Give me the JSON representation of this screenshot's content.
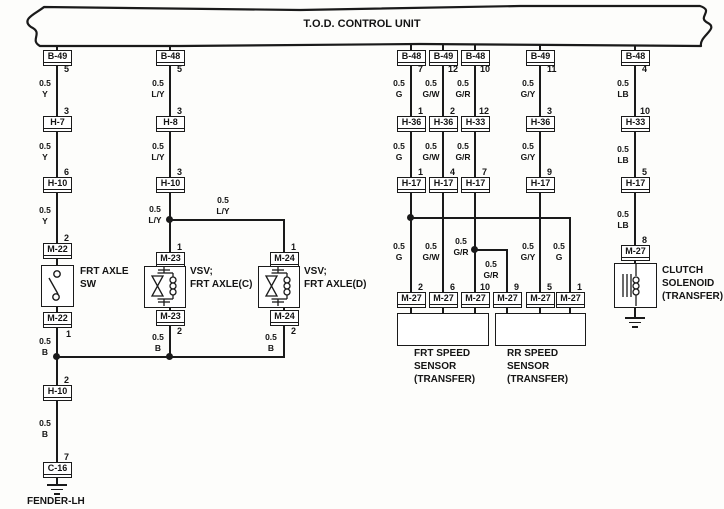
{
  "title": "T.O.D. CONTROL UNIT",
  "footer_label": "FENDER-LH",
  "boxes": {
    "c1_b49": {
      "name": "B-49",
      "pin": "5"
    },
    "c1_h7": {
      "name": "H-7",
      "pin": "3"
    },
    "c1_h10a": {
      "name": "H-10",
      "pin": "6"
    },
    "c1_m22a": {
      "name": "M-22",
      "pin": "2"
    },
    "c1_m22b": {
      "name": "M-22",
      "pin": "1"
    },
    "c1_h10b": {
      "name": "H-10",
      "pin": "2"
    },
    "c1_c16": {
      "name": "C-16",
      "pin": "7"
    },
    "c2_b48": {
      "name": "B-48",
      "pin": "5"
    },
    "c2_h8": {
      "name": "H-8",
      "pin": "3"
    },
    "c2_h10": {
      "name": "H-10",
      "pin": "3"
    },
    "c2_m23a": {
      "name": "M-23",
      "pin": "1"
    },
    "c2_m23b": {
      "name": "M-23",
      "pin": "2"
    },
    "c2b_m24a": {
      "name": "M-24",
      "pin": "1"
    },
    "c2b_m24b": {
      "name": "M-24",
      "pin": "2"
    },
    "c3_b48": {
      "name": "B-48",
      "pin": "7"
    },
    "c3_h36": {
      "name": "H-36",
      "pin": "1"
    },
    "c3_h17": {
      "name": "H-17",
      "pin": "1"
    },
    "c3_m27": {
      "name": "M-27",
      "pin": "2"
    },
    "c4_b49": {
      "name": "B-49",
      "pin": "12"
    },
    "c4_h36": {
      "name": "H-36",
      "pin": "2"
    },
    "c4_h17": {
      "name": "H-17",
      "pin": "4"
    },
    "c4_m27": {
      "name": "M-27",
      "pin": "6"
    },
    "c5_b48": {
      "name": "B-48",
      "pin": "10"
    },
    "c5_h33": {
      "name": "H-33",
      "pin": "12"
    },
    "c5_h17": {
      "name": "H-17",
      "pin": "7"
    },
    "c5_m27": {
      "name": "M-27",
      "pin": "10"
    },
    "c5b_m27": {
      "name": "M-27",
      "pin": "9"
    },
    "c6_b49": {
      "name": "B-49",
      "pin": "11"
    },
    "c6_h36": {
      "name": "H-36",
      "pin": "3"
    },
    "c6_h17": {
      "name": "H-17",
      "pin": "9"
    },
    "c6_m27": {
      "name": "M-27",
      "pin": "5"
    },
    "c6b_m27": {
      "name": "M-27",
      "pin": "1"
    },
    "c7_b48": {
      "name": "B-48",
      "pin": "4"
    },
    "c7_h33": {
      "name": "H-33",
      "pin": "10"
    },
    "c7_h17": {
      "name": "H-17",
      "pin": "5"
    },
    "c7_m27": {
      "name": "M-27",
      "pin": "8"
    }
  },
  "wire_labels": {
    "c1_w1": {
      "size": "0.5",
      "color": "Y"
    },
    "c1_w2": {
      "size": "0.5",
      "color": "Y"
    },
    "c1_w3": {
      "size": "0.5",
      "color": "Y"
    },
    "c1_w4": {
      "size": "0.5",
      "color": "B"
    },
    "c1_w5": {
      "size": "0.5",
      "color": "B"
    },
    "c2_w1": {
      "size": "0.5",
      "color": "L/Y"
    },
    "c2_w2": {
      "size": "0.5",
      "color": "L/Y"
    },
    "c2_w3": {
      "size": "0.5",
      "color": "L/Y"
    },
    "c2_w4": {
      "size": "0.5",
      "color": "B"
    },
    "branch_ly": {
      "size": "0.5",
      "color": "L/Y"
    },
    "c2b_w1": {
      "size": "0.5",
      "color": "B"
    },
    "c3_w1": {
      "size": "0.5",
      "color": "G"
    },
    "c3_w2": {
      "size": "0.5",
      "color": "G"
    },
    "c3_w3": {
      "size": "0.5",
      "color": "G"
    },
    "c4_w1": {
      "size": "0.5",
      "color": "G/W"
    },
    "c4_w2": {
      "size": "0.5",
      "color": "G/W"
    },
    "c4_w3": {
      "size": "0.5",
      "color": "G/W"
    },
    "c5_w1": {
      "size": "0.5",
      "color": "G/R"
    },
    "c5_w2": {
      "size": "0.5",
      "color": "G/R"
    },
    "c5_w3": {
      "size": "0.5",
      "color": "G/R"
    },
    "c5_wb": {
      "size": "0.5",
      "color": "G/R"
    },
    "c6_w1": {
      "size": "0.5",
      "color": "G/Y"
    },
    "c6_w2": {
      "size": "0.5",
      "color": "G/Y"
    },
    "c6_w3": {
      "size": "0.5",
      "color": "G/Y"
    },
    "c6b_w1": {
      "size": "0.5",
      "color": "G"
    },
    "c7_w1": {
      "size": "0.5",
      "color": "LB"
    },
    "c7_w2": {
      "size": "0.5",
      "color": "LB"
    },
    "c7_w3": {
      "size": "0.5",
      "color": "LB"
    }
  },
  "devices": {
    "frt_axle_sw": {
      "line1": "FRT AXLE",
      "line2": "SW"
    },
    "vsv_c": {
      "line1": "VSV;",
      "line2": "FRT AXLE(C)"
    },
    "vsv_d": {
      "line1": "VSV;",
      "line2": "FRT AXLE(D)"
    },
    "frt_speed_sensor": {
      "line1": "FRT SPEED",
      "line2": "SENSOR",
      "line3": "(TRANSFER)"
    },
    "rr_speed_sensor": {
      "line1": "RR SPEED",
      "line2": "SENSOR",
      "line3": "(TRANSFER)"
    },
    "clutch_solenoid": {
      "line1": "CLUTCH",
      "line2": "SOLENOID",
      "line3": "(TRANSFER)"
    }
  }
}
